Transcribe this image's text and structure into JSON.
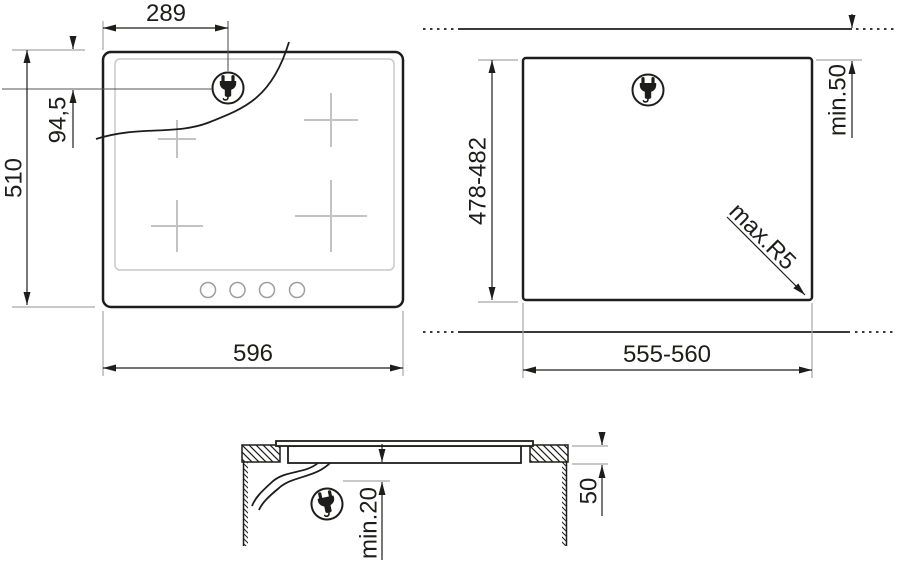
{
  "drawing": {
    "front_view": {
      "plug_offset_width": "289",
      "plug_offset_depth": "94,5",
      "overall_depth": "510",
      "overall_width": "596"
    },
    "cutout_view": {
      "cutout_depth": "478-482",
      "cutout_width": "555-560",
      "rear_clearance": "min.50",
      "corner_radius": "max.R5"
    },
    "section_view": {
      "under_clearance": "min.20",
      "worktop_thickness": "50"
    },
    "colors": {
      "line": "#1d1d1b",
      "extension_line": "#a6a6a6",
      "zone_mark": "#c3c3c3"
    }
  }
}
